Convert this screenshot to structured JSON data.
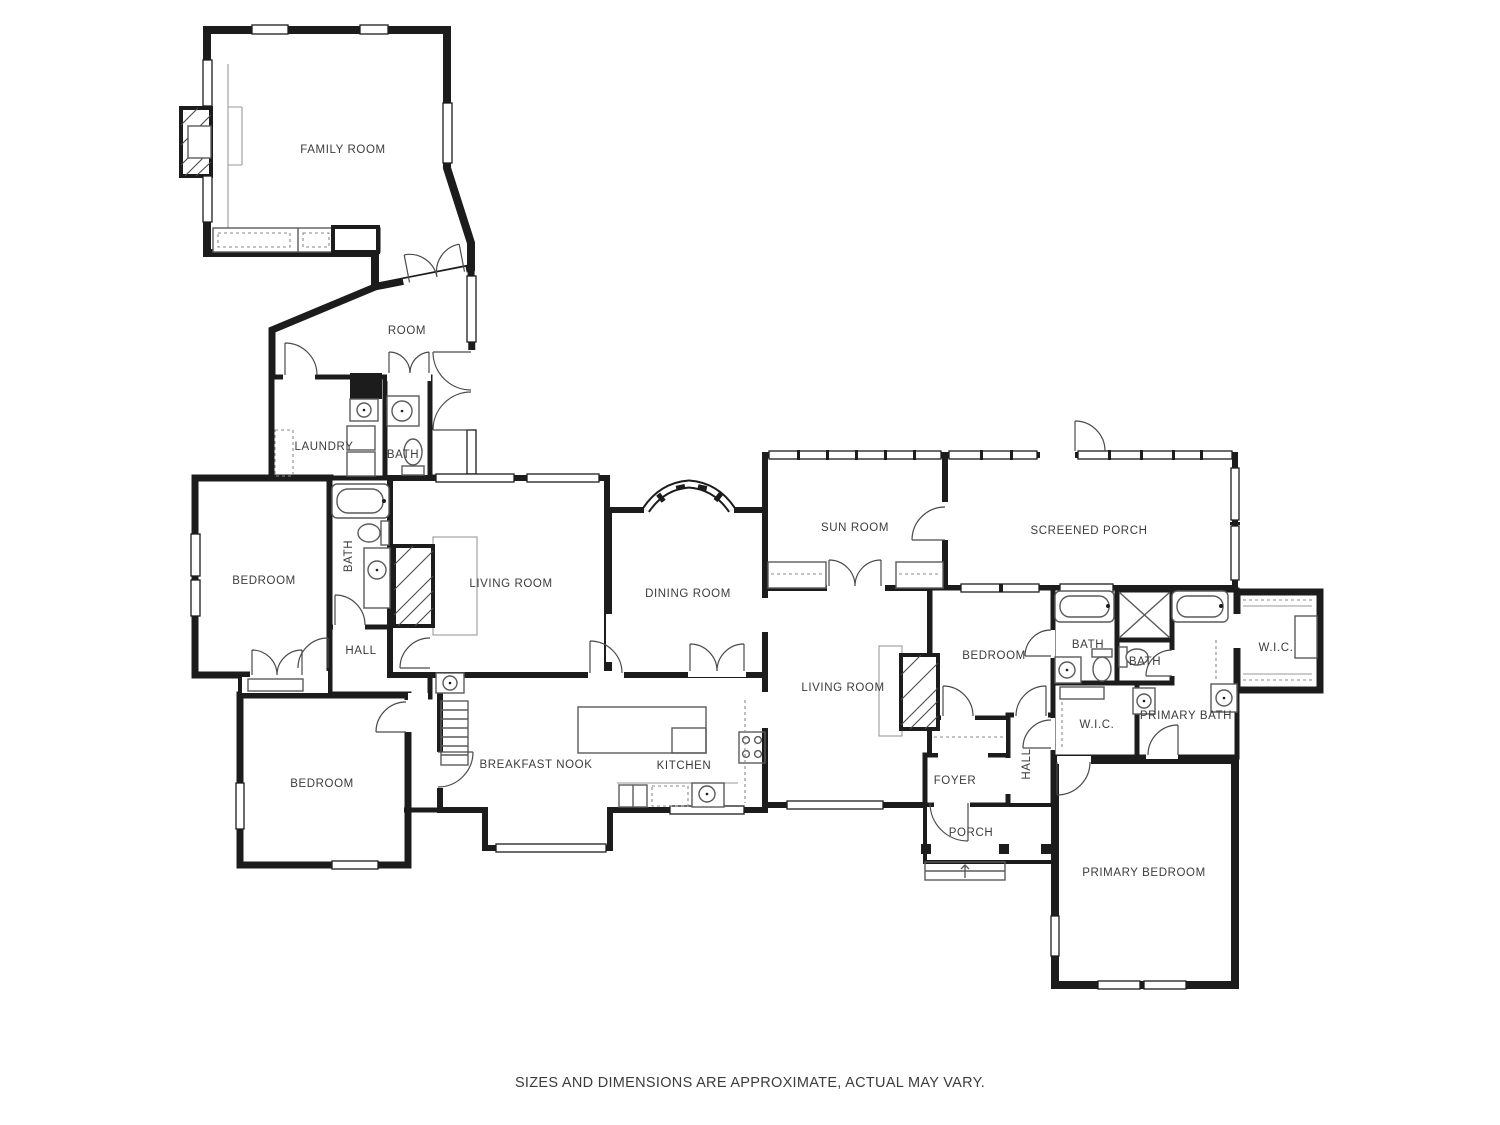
{
  "page": {
    "footer": "SIZES AND DIMENSIONS ARE APPROXIMATE, ACTUAL MAY VARY."
  },
  "plan": {
    "type": "residential-floor-plan",
    "wall_color": "#1c1c1c",
    "fixture_color": "#5a5a5a",
    "label_color": "#3c3c3c",
    "background_color": "#ffffff",
    "rooms": [
      {
        "id": "family-room",
        "label": "FAMILY ROOM"
      },
      {
        "id": "room",
        "label": "ROOM"
      },
      {
        "id": "laundry",
        "label": "LAUNDRY"
      },
      {
        "id": "bath-upper",
        "label": "BATH"
      },
      {
        "id": "bedroom-west",
        "label": "BEDROOM"
      },
      {
        "id": "bath-west",
        "label": "BATH"
      },
      {
        "id": "hall-west",
        "label": "HALL"
      },
      {
        "id": "living-room-west",
        "label": "LIVING ROOM"
      },
      {
        "id": "dining-room",
        "label": "DINING ROOM"
      },
      {
        "id": "sun-room",
        "label": "SUN ROOM"
      },
      {
        "id": "screened-porch",
        "label": "SCREENED PORCH"
      },
      {
        "id": "bedroom-middle",
        "label": "BEDROOM"
      },
      {
        "id": "bath-middle",
        "label": "BATH"
      },
      {
        "id": "bath-small",
        "label": "BATH"
      },
      {
        "id": "wic-east",
        "label": "W.I.C."
      },
      {
        "id": "primary-bath",
        "label": "PRIMARY BATH"
      },
      {
        "id": "wic-middle",
        "label": "W.I.C."
      },
      {
        "id": "living-room-east",
        "label": "LIVING ROOM"
      },
      {
        "id": "hall-east",
        "label": "HALL"
      },
      {
        "id": "foyer",
        "label": "FOYER"
      },
      {
        "id": "porch",
        "label": "PORCH"
      },
      {
        "id": "breakfast-nook",
        "label": "BREAKFAST NOOK"
      },
      {
        "id": "kitchen",
        "label": "KITCHEN"
      },
      {
        "id": "bedroom-southwest",
        "label": "BEDROOM"
      },
      {
        "id": "primary-bedroom",
        "label": "PRIMARY BEDROOM"
      }
    ]
  }
}
